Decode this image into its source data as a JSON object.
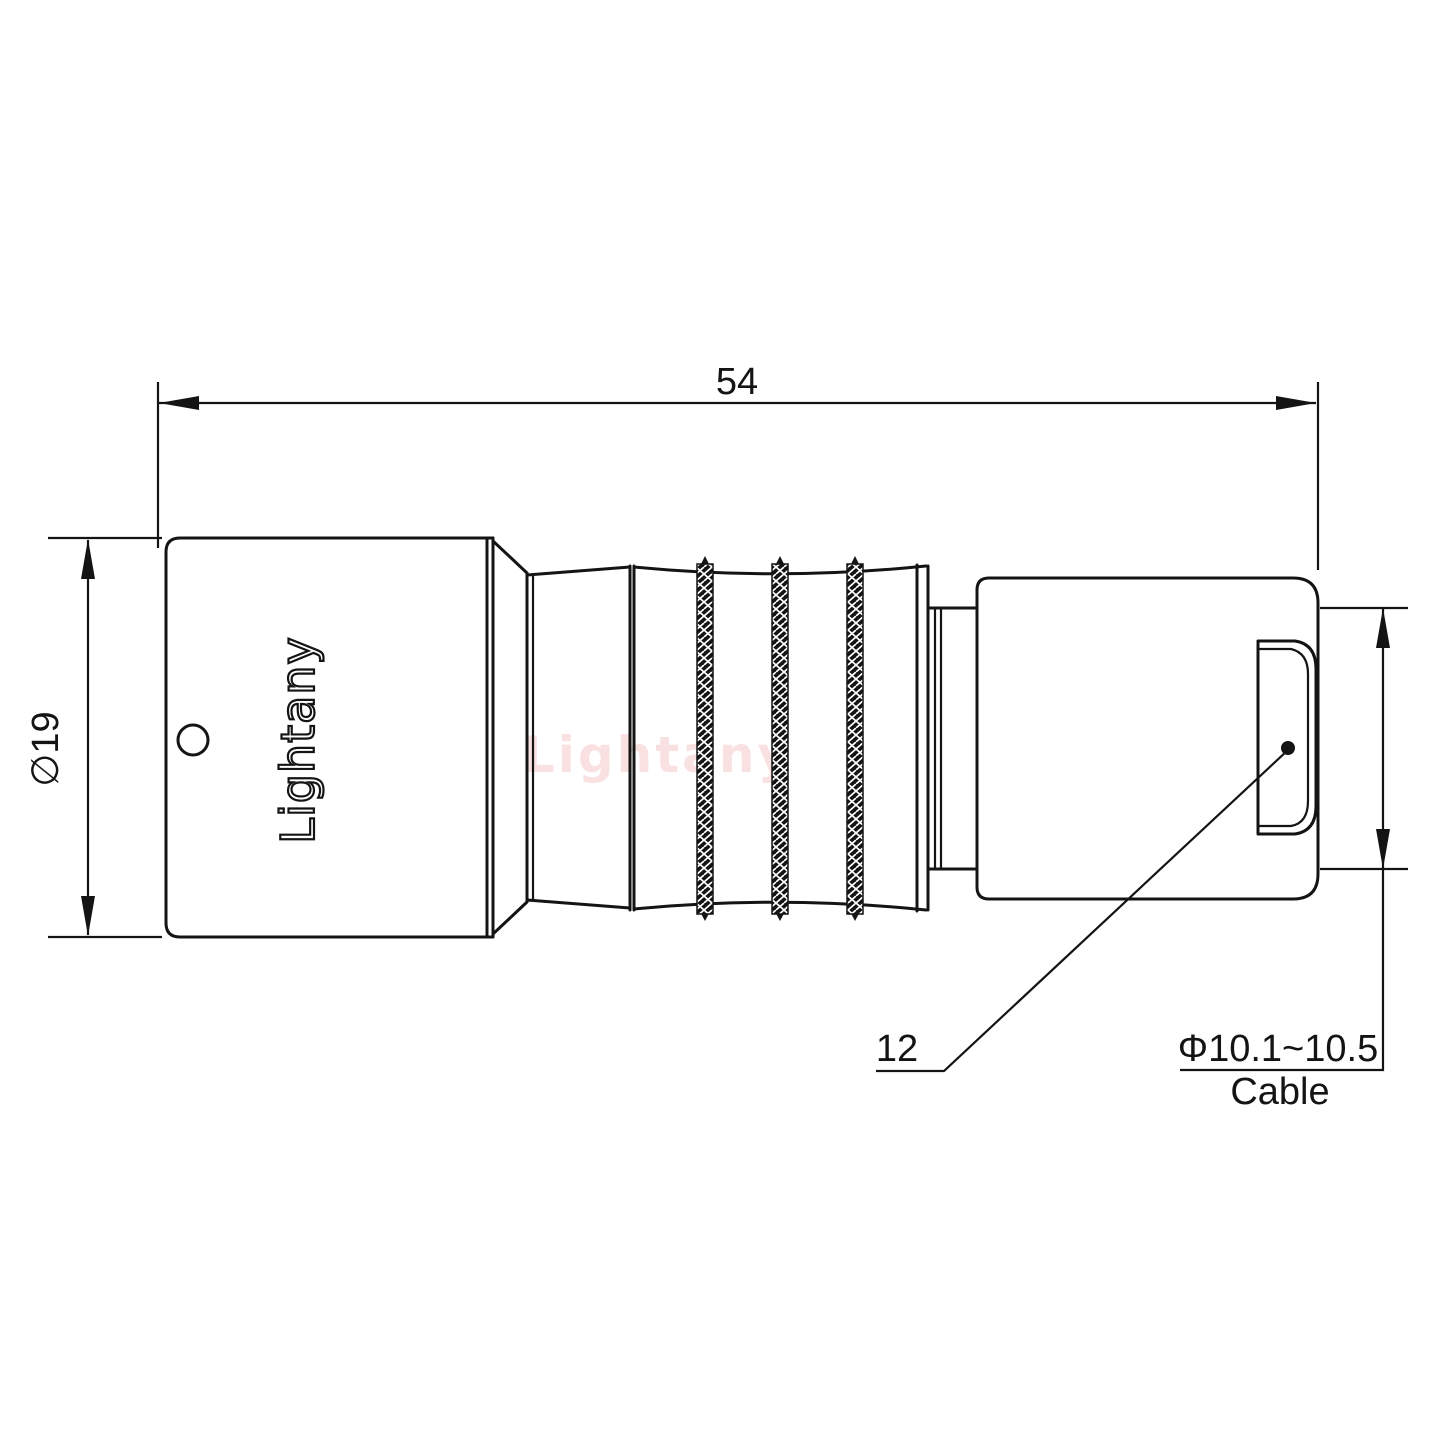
{
  "drawing": {
    "line_color": "#141414",
    "background": "#ffffff"
  },
  "watermark": {
    "text": "Lightany",
    "color": "#f6caca"
  },
  "body_engraving": {
    "text": "Lightany"
  },
  "dimensions": {
    "overall_length": {
      "label": "54"
    },
    "body_diameter": {
      "label": "∅19"
    },
    "rear_part": {
      "label": "12"
    },
    "cable": {
      "diameter_label": "Φ10.1~10.5",
      "name_label": "Cable"
    }
  }
}
